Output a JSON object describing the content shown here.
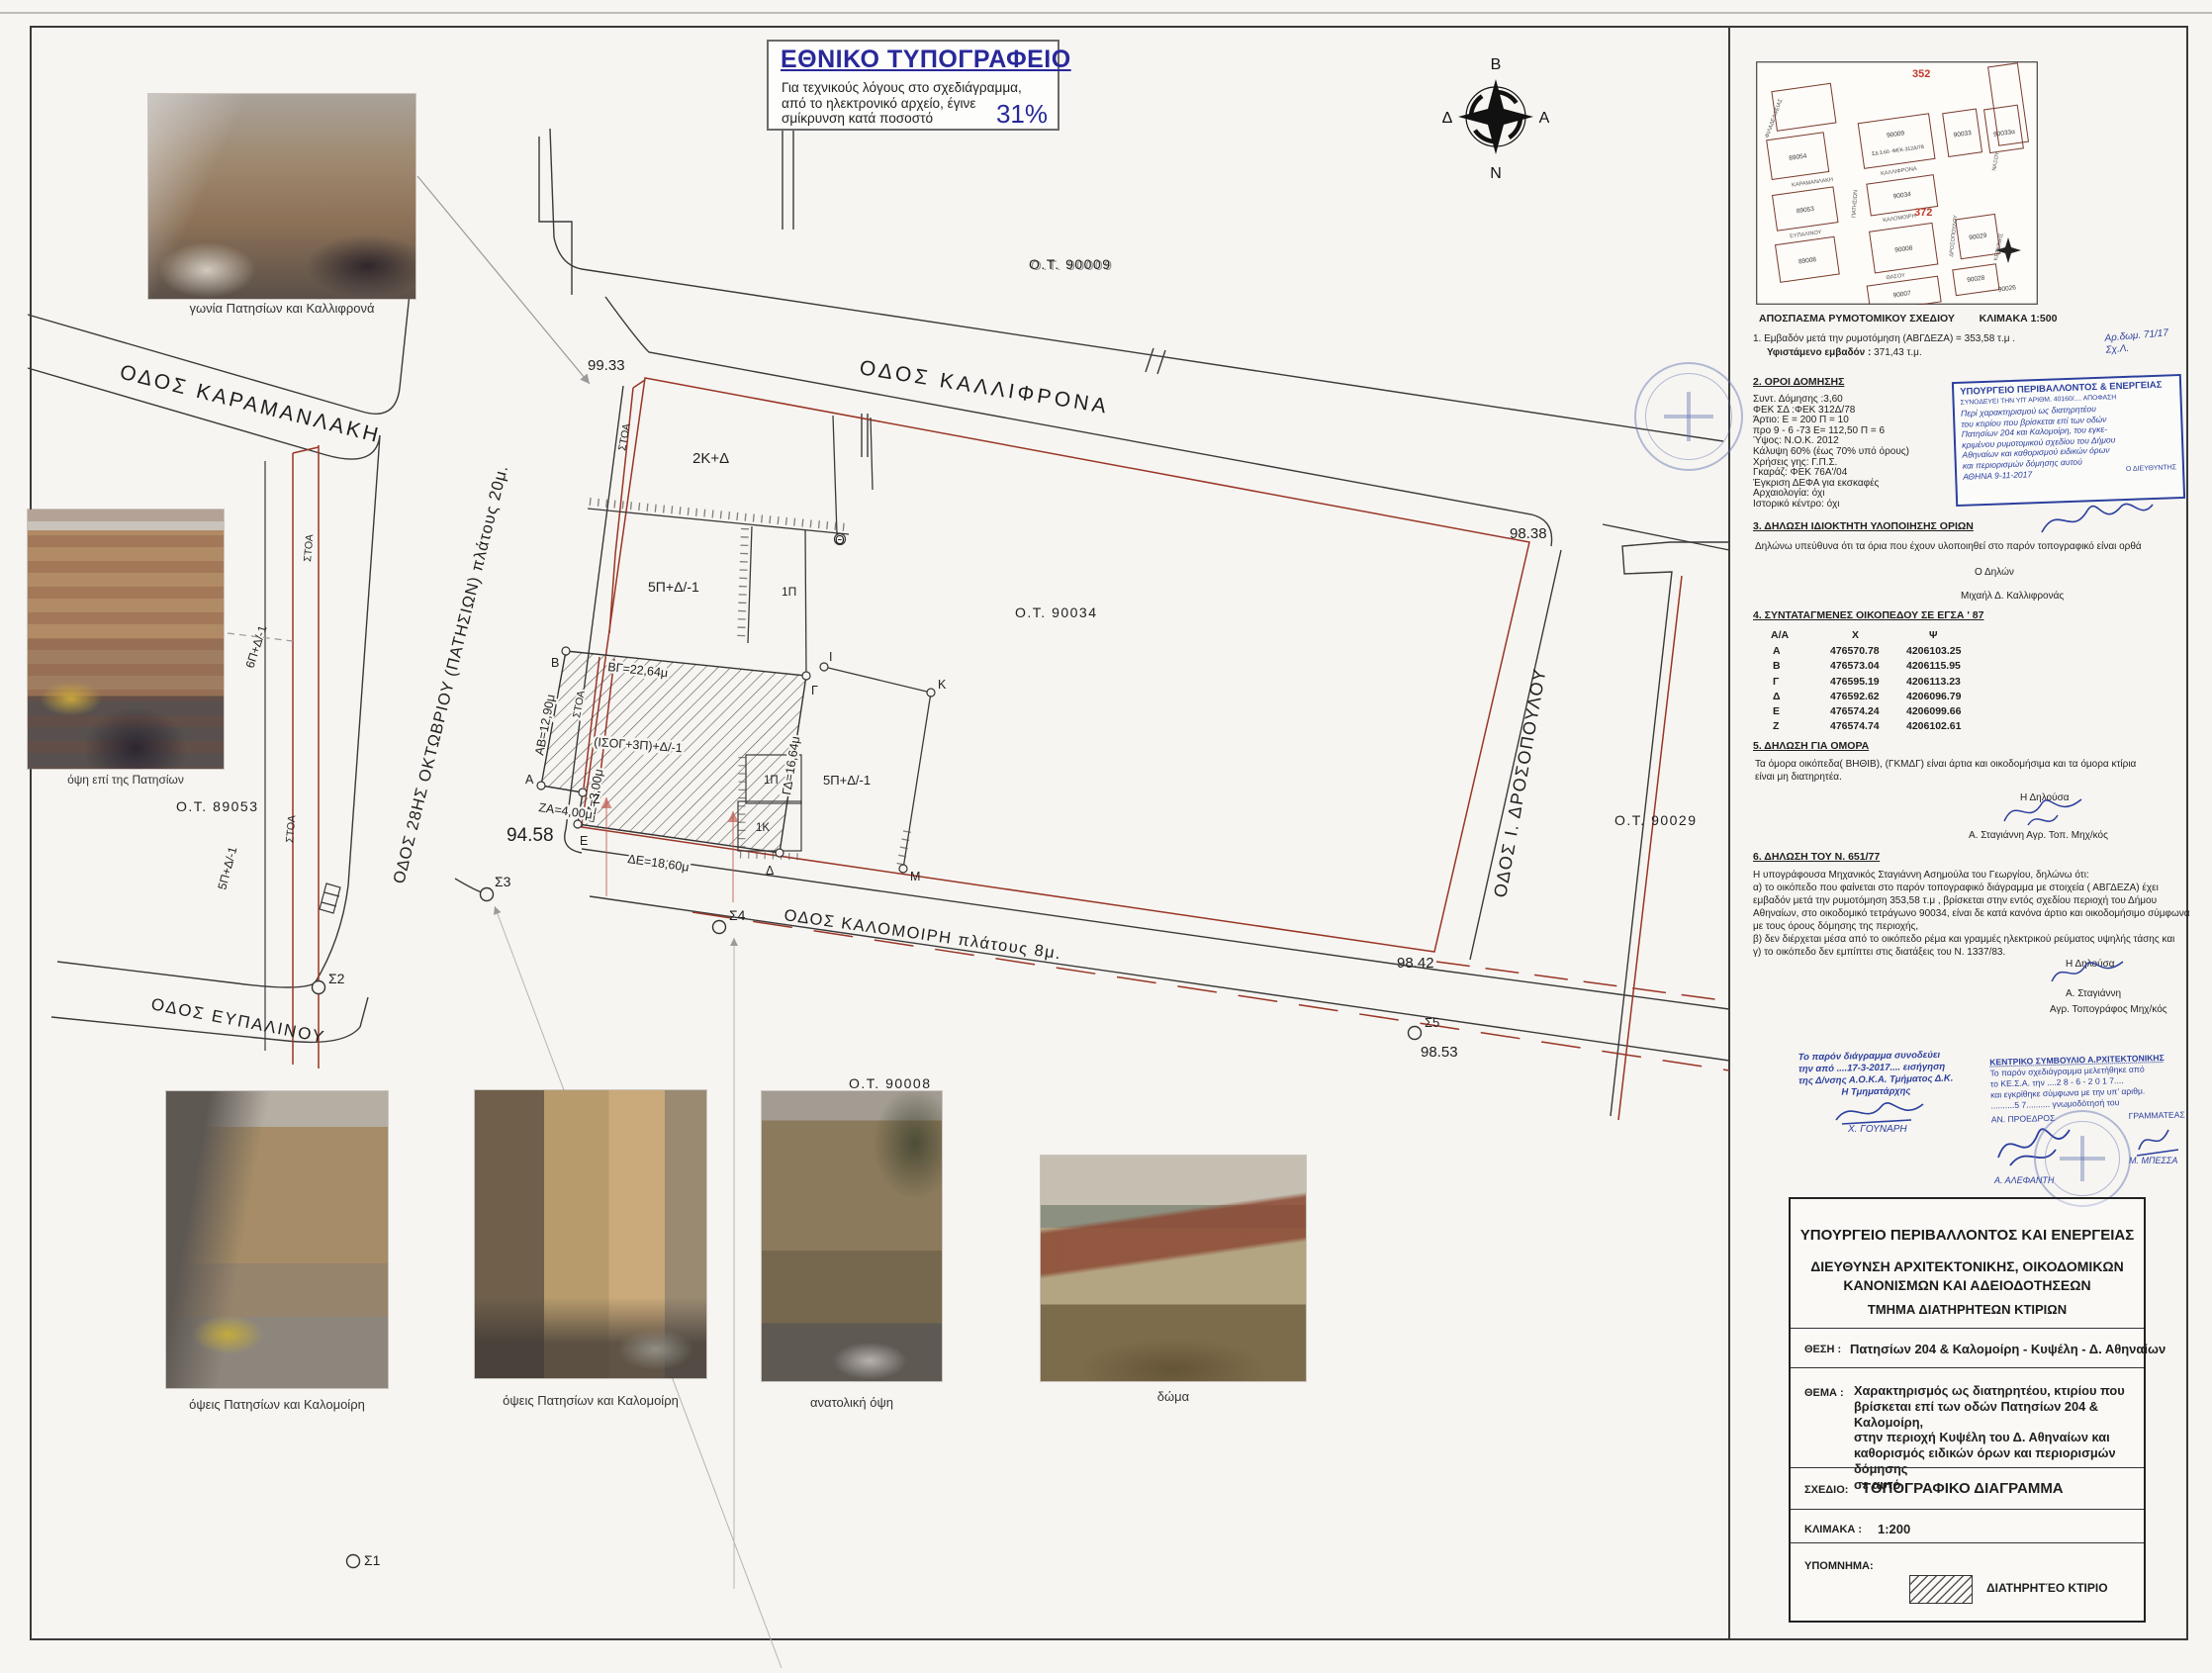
{
  "notice_box": {
    "title": "ΕΘΝΙΚΟ ΤΥΠΟΓΡΑΦΕΙΟ",
    "line1": "Για  τεχνικούς  λόγους  στο  σχεδιάγραμμα,",
    "line2": "από το ηλεκτρονικό αρχείο, έγινε",
    "line3": "σμίκρυνση κατά ποσοστό",
    "percent": "31%"
  },
  "compass": {
    "north": "Β",
    "south": "Ν",
    "west": "Δ",
    "east": "Α"
  },
  "inset_map": {
    "caption": "ΑΠΟΣΠΑΣΜΑ ΡΥΜΟΤΟΜΙΚΟΥ ΣΧΕΔΙΟΥ",
    "caption_scale": "ΚΛΙΜΑΚΑ 1:500",
    "ref_352": "352",
    "ref_372": "372",
    "sd_note": "ΣΔ 3.60 -ΦΕΚ-312Δ/78",
    "blocks": {
      "b89054": "89054",
      "b90009": "90009",
      "b90033": "90033",
      "b90033a": "90033α",
      "b89053": "89053",
      "b90034": "90034",
      "b89008": "89008",
      "b90008": "90008",
      "b90029": "90029",
      "b90007": "90007",
      "b90028": "90028",
      "b90026": "90026"
    },
    "streets": {
      "filadelfias": "ΦΙΛΑΔΕΛΦΕΙΑΣ",
      "karamanlaki": "ΚΑΡΑΜΑΝΛΑΚΗ",
      "kalifrona": "ΚΑΛΛΙΦΡΟΝΑ",
      "patision": "ΠΑΤΗΣΙΩΝ",
      "eupalinou": "ΕΥΠΑΛΙΝΟΥ",
      "kalomoiri": "ΚΑΛΟΜΟΙΡΗ",
      "drosopoulou": "ΔΡΟΣΟΠΟΥΛΟΥ",
      "thasou": "ΘΑΣΟΥ",
      "naxou": "ΝΑΞΟΥ",
      "kerkinis": "ΚΕΡΚΙΝΗΣ"
    }
  },
  "sections": {
    "item1_line1": "1.  Εμβαδόν μετά την ρυμοτόμηση  (ΑΒΓΔΕΖΑ) = 353,58 τ.μ .",
    "item1_line2_label": "Υφιστάμενο εμβαδόν :",
    "item1_line2_value": " 371,43 τ.μ.",
    "s2_title": "2. ΟΡΟΙ ΔΟΜΗΣΗΣ",
    "s2_lines": [
      "Συντ. Δόμησης :3,60",
      "ΦΕΚ ΣΔ :ΦΕΚ 312Δ/78",
      "Άρτιο: Ε = 200 Π = 10",
      "προ 9 - 6 -73 Ε= 112,50 Π = 6",
      "Ύψος: Ν.Ο.Κ. 2012",
      "Κάλυψη 60% (έως 70% υπό όρους)",
      "Χρήσεις γης: Γ.Π.Σ.",
      "Γκαράζ: ΦΕΚ 76Α'/04",
      "Έγκριση ΔΕΦΑ για εκσκαφές",
      "Αρχαιολογία: όχι",
      "Ιστορικό κέντρο: όχι"
    ],
    "s3_title": "3. ΔΗΛΩΣΗ ΙΔΙΟΚΤΗΤΗ ΥΛΟΠΟΙΗΣΗΣ ΟΡΙΩΝ",
    "s3_body": "Δηλώνω υπεύθυνα ότι τα όρια που έχουν υλοποιηθεί στο παρόν τοπογραφικό  είναι ορθά",
    "s3_declarer_label": "Ο Δηλών",
    "s3_declarer_name": "Μιχαήλ Δ. Καλλιφρονάς",
    "s4_title": "4. ΣΥΝΤΑΤΑΓΜΕΝΕΣ ΟΙΚΟΠΕΔΟΥ ΣΕ ΕΓΣΑ ' 87",
    "coords_headers": [
      "Α/Α",
      "Χ",
      "Ψ"
    ],
    "coords_rows": [
      [
        "Α",
        "476570.78",
        "4206103.25"
      ],
      [
        "Β",
        "476573.04",
        "4206115.95"
      ],
      [
        "Γ",
        "476595.19",
        "4206113.23"
      ],
      [
        "Δ",
        "476592.62",
        "4206096.79"
      ],
      [
        "Ε",
        "476574.24",
        "4206099.66"
      ],
      [
        "Ζ",
        "476574.74",
        "4206102.61"
      ]
    ],
    "s5_title": "5. ΔΗΛΩΣΗ ΓΙΑ ΟΜΟΡΑ",
    "s5_body_l1": "Τα όμορα οικόπεδα( ΒΗΘΙΒ), (ΓΚΜΔΓ) είναι άρτια και οικοδομήσιμα και τα όμορα κτίρια",
    "s5_body_l2": "είναι μη διατηρητέα.",
    "s5_declarer_label": "Η Δηλούσα",
    "s5_declarer_name": "Α. Σταγιάννη  Αγρ. Τοπ. Μηχ/κός",
    "s6_title": "6. ΔΗΛΩΣΗ ΤΟΥ Ν. 651/77",
    "s6_lines": [
      "Η υπογράφουσα Μηχανικός Σταγιάννη Ασημούλα του Γεωργίου, δηλώνω ότι:",
      "α) το οικόπεδο που φαίνεται στο παρόν τοπογραφικό διάγραμμα με στοιχεία ( ΑΒΓΔΕΖΑ) έχει",
      "εμβαδόν μετά την ρυμοτόμηση 353,58 τ.μ , βρίσκεται στην εντός σχεδίου περιοχή του Δήμου",
      "Αθηναίων, στο οικοδομικό τετράγωνο 90034, είναι δε κατά κανόνα άρτιο και οικοδομήσιμο σύμφωνα",
      "με τους όρους δόμησης της περιοχής,",
      "β) δεν διέρχεται μέσα από το οικόπεδο ρέμα και γραμμές ηλεκτρικού ρεύματος υψηλής τάσης και",
      "γ) το οικόπεδο δεν εμπίπτει στις διατάξεις του Ν. 1337/83."
    ],
    "s6_declarer_label": "Η  Δηλούσα",
    "s6_declarer_name": "Α. Σταγιάννη",
    "s6_declarer_title": "Αγρ. Τοπογράφος Μηχ/κός"
  },
  "stamps": {
    "ministry_header": "ΥΠΟΥΡΓΕΙΟ ΠΕΡΙΒΑΛΛΟΝΤΟΣ & ΕΝΕΡΓΕΙΑΣ",
    "ministry_sub": "ΣΥΝΟΔΕΥΕΙ ΤΗΝ ΥΠ' ΑΡΙΘΜ. 40160/.... ΑΠΟΦΑΣΗ",
    "ministry_hand": [
      "Περί χαρακτηρισμού ως διατηρητέου",
      "του κτιρίου που βρίσκεται επί των οδών",
      "Πατησίων 204 και Καλομοίρη, του εγκε-",
      "κριμένου ρυμοτομικού σχεδίου του Δήμου",
      "Αθηναίων και καθορισμού ειδικών όρων",
      "και περιορισμών δόμησης αυτού"
    ],
    "ministry_date": "ΑΘΗΝΑ 9-11-2017",
    "ministry_role": "Ο ΔΙΕΥΘΥΝΤΗΣ",
    "side_note_l1": "Αρ.δωμ. 71/17",
    "side_note_l2": "Σχ.Λ.",
    "accompany_lines": [
      "Το παρόν  διάγραμμα  συνοδεύει",
      "την  από ....17-3-2017.... εισήγηση",
      "της  Δ/νσης  Α.Ο.Κ.Α. Τμήματος  Δ.Κ.",
      "Η  Τμηματάρχης"
    ],
    "accompany_name": "Χ. ΓΟΥΝΑΡΗ",
    "kesa_title": "ΚΕΝΤΡΙΚΟ ΣΥΜΒΟΥΛΙΟ Α.ΡΧΙΤΕΚΤΟΝΙΚΗΣ",
    "kesa_lines": [
      "Το παρόν σχεδιάγραμμα μελετήθηκε από",
      "το ΚΕ.Σ.Α. την ....2 8 - 6 - 2 0 1 7....",
      "και εγκρίθηκε σύμφωνα με την υπ’ αριθμ.",
      "..........5 7.......... γνωμοδότησή του"
    ],
    "kesa_role_left": "ΑΝ. ΠΡΟΕΔΡΟΣ",
    "kesa_role_right": "ΓΡΑΜΜΑΤΕΑΣ",
    "kesa_name_left": "Α. ΑΛΕΦΑΝΤΗ",
    "kesa_name_right": "Μ. ΜΠΕΣΣΑ"
  },
  "title_block": {
    "l1": "ΥΠΟΥΡΓΕΙΟ  ΠΕΡΙΒΑΛΛΟΝΤΟΣ  ΚΑΙ  ΕΝΕΡΓΕΙΑΣ",
    "l2": "ΔΙΕΥΘΥΝΣΗ  ΑΡΧΙΤΕΚΤΟΝΙΚΗΣ,  ΟΙΚΟΔΟΜΙΚΩΝ",
    "l3": "ΚΑΝΟΝΙΣΜΩΝ  ΚΑΙ  ΑΔΕΙΟΔΟΤΗΣΕΩΝ",
    "l4": "ΤΜΗΜΑ  ΔΙΑΤΗΡΗΤΕΩΝ  ΚΤΙΡΙΩΝ",
    "thesi_label": "ΘΕΣΗ :",
    "thesi": "Πατησίων 204  &  Καλομοίρη   -  Κυψέλη -  Δ. Αθηναίων",
    "thema_label": "ΘΕΜΑ :",
    "thema_lines": [
      "Χαρακτηρισμός   ως   διατηρητέου,   κτιρίου   που",
      "βρίσκεται επί των οδών Πατησίων 204  & Καλομοίρη,",
      "στην   περιοχή   Κυψέλη   του   Δ.   Αθηναίων   και",
      "καθορισμός ειδικών όρων και περιορισμών δόμησης",
      "σε αυτό."
    ],
    "sxedio_label": "ΣΧΕΔΙΟ:",
    "sxedio": "ΤΟΠΟΓΡΑΦΙΚΟ  ΔΙΑΓΡΑΜΜΑ",
    "klimaka_label": "ΚΛΙΜΑΚΑ :",
    "klimaka": "1:200",
    "ypomnima_label": "ΥΠΟΜΝΗΜΑ:",
    "legend_item": "ΔΙΑΤΗΡΗΤΈΟ  ΚΤΙΡΙΟ"
  },
  "plan": {
    "streets": {
      "kalifrona": "ΟΔΟΣ ΚΑΛΛΙΦΡΟΝΑ",
      "karamanlaki": "ΟΔΟΣ ΚΑΡΑΜΑΝΛΑΚΗ",
      "patision": "ΟΔΟΣ 28ΗΣ ΟΚΤΩΒΡΙΟΥ (ΠΑΤΗΣΙΩΝ) πλάτους 20μ.",
      "drosopoulou": "ΟΔΟΣ Ι. ΔΡΟΣΟΠΟΥΛΟΥ",
      "kalomoiri": "ΟΔΟΣ ΚΑΛΟΜΟΙΡΗ πλάτους 8μ.",
      "eupalinou": "ΟΔΟΣ ΕΥΠΑΛΙΝΟΥ"
    },
    "blocks": {
      "ot90009": "Ο.Τ.  90009",
      "ot90034": "Ο.Τ.  90034",
      "ot89053": "Ο.Τ.  89053",
      "ot90029": "Ο.Τ.  90029",
      "ot90008": "Ο.Τ.  90008"
    },
    "elevations": {
      "e9933": "99.33",
      "e9838": "98.38",
      "e9458": "94.58",
      "e9842": "98.42",
      "e9853": "98.53"
    },
    "points": {
      "s1": "Σ1",
      "s2": "Σ2",
      "s3": "Σ3",
      "s4": "Σ4",
      "s5": "Σ5"
    },
    "buildings": {
      "b2kd": "2Κ+Δ",
      "b5pd": "5Π+Δ/-1",
      "b1p": "1Π",
      "b1k": "1Κ",
      "b6pd": "6Π+Δ/-1",
      "main": "(ΙΣΟΓ+3Π)+Δ/-1",
      "stoa": "ΣΤΟΑ"
    },
    "dims": {
      "ab": "ΑΒ=12,90μ",
      "bg": "ΒΓ=22,64μ",
      "gd": "ΓΔ=16,64μ",
      "de": "ΔΕ=18,60μ",
      "ez": "ΕΖ=3,00μ",
      "za": "ΖΑ=4,00μ"
    },
    "vertices": {
      "a": "Α",
      "b": "Β",
      "g": "Γ",
      "d": "Δ",
      "e": "Ε",
      "z": "Ζ",
      "th": "Θ",
      "i": "Ι",
      "k": "Κ",
      "m": "Μ"
    }
  },
  "photos": {
    "p1_caption": "γωνία Πατησίων και Καλλιφρονά",
    "p2_caption": "όψη επί της Πατησίων",
    "p3_caption": "όψεις Πατησίων και Καλομοίρη",
    "p4_caption": "όψεις Πατησίων και Καλομοίρη",
    "p5_caption": "ανατολική όψη",
    "p6_caption": "δώμα"
  }
}
